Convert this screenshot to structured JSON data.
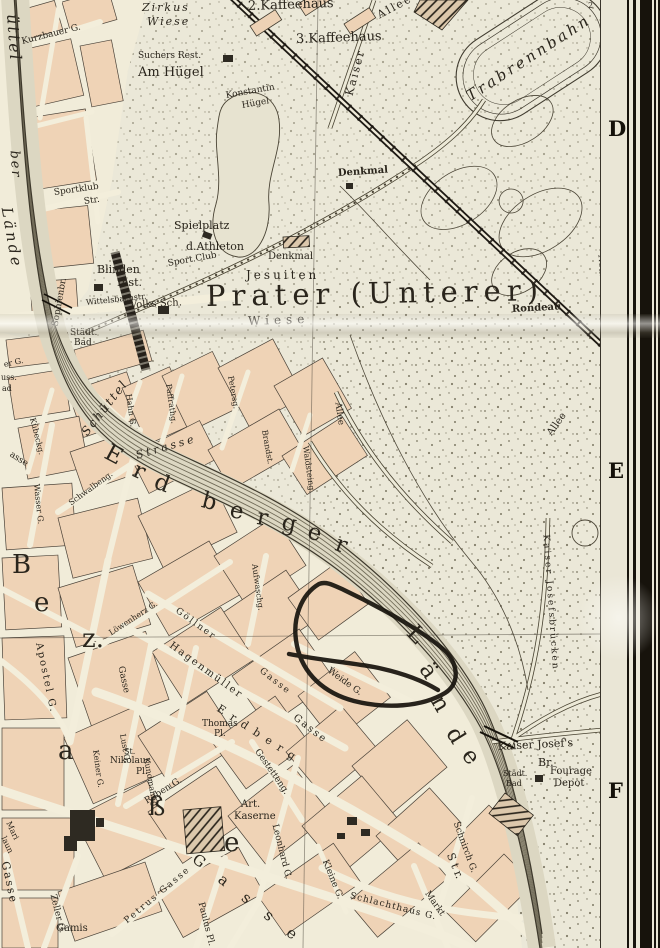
{
  "map": {
    "region_title": "Prater (Unterer)",
    "colors": {
      "paper": "#ebe8d8",
      "city_block": "#efd3b6",
      "street": "#f3eedb",
      "print_ink": "#2a251c",
      "water_hatch": "#57513e",
      "handwritten_annotation": "#17130d",
      "margin_paper": "#eae6d6",
      "frame_bar": "#17130c"
    },
    "annotation_ink": {
      "description": "hand-drawn black ink loop around blocks near Weide G.",
      "color": "#17130d"
    },
    "margin": {
      "letters": [
        {
          "t": "D",
          "y": 116
        },
        {
          "t": "E",
          "y": 458
        },
        {
          "t": "F",
          "y": 778
        }
      ]
    },
    "labels": [
      {
        "t": "Zirkus",
        "x": 142,
        "y": 2,
        "r": 0,
        "s": 11,
        "c": "pli sp2"
      },
      {
        "t": "Wiese",
        "x": 147,
        "y": 16,
        "r": 0,
        "s": 11,
        "c": "pli sp2"
      },
      {
        "t": "2.Kaffeehaus",
        "x": 248,
        "y": 0,
        "r": -2,
        "s": 13,
        "c": "pl"
      },
      {
        "t": "3.Kaffeehaus",
        "x": 296,
        "y": 33,
        "r": -2,
        "s": 13,
        "c": "pl"
      },
      {
        "t": "Suchers Rest.",
        "x": 138,
        "y": 52,
        "r": 0,
        "s": 9,
        "c": "pl"
      },
      {
        "t": "Am Hügel",
        "x": 138,
        "y": 66,
        "r": 0,
        "s": 13,
        "c": "pl"
      },
      {
        "t": "Konstantin",
        "x": 226,
        "y": 92,
        "r": -10,
        "s": 9,
        "c": "pl"
      },
      {
        "t": "Hügel",
        "x": 242,
        "y": 102,
        "r": -10,
        "s": 9,
        "c": "pl"
      },
      {
        "t": "Kaiser",
        "x": 349,
        "y": 90,
        "r": -75,
        "s": 11,
        "c": "pl sp2"
      },
      {
        "t": "Allee",
        "x": 378,
        "y": 10,
        "r": -28,
        "s": 11,
        "c": "pl sp2"
      },
      {
        "t": "Trabrennbahn",
        "x": 468,
        "y": 90,
        "r": -33,
        "s": 15,
        "c": "pli sp3"
      },
      {
        "t": "Kurzbauer G.",
        "x": 22,
        "y": 38,
        "r": -14,
        "s": 9,
        "c": "st"
      },
      {
        "t": "Sportklub",
        "x": 54,
        "y": 189,
        "r": -8,
        "s": 9,
        "c": "st"
      },
      {
        "t": "Str.",
        "x": 84,
        "y": 198,
        "r": -8,
        "s": 9,
        "c": "st"
      },
      {
        "t": "Denkmal",
        "x": 338,
        "y": 169,
        "r": -4,
        "s": 10,
        "c": "plb"
      },
      {
        "t": "Spielplatz",
        "x": 174,
        "y": 220,
        "r": 0,
        "s": 11,
        "c": "pl"
      },
      {
        "t": "d.Athleton",
        "x": 186,
        "y": 241,
        "r": 0,
        "s": 11,
        "c": "pl"
      },
      {
        "t": "Sport.Club",
        "x": 168,
        "y": 260,
        "r": -10,
        "s": 9,
        "c": "st"
      },
      {
        "t": "Denkmal",
        "x": 268,
        "y": 252,
        "r": 0,
        "s": 10,
        "c": "pl"
      },
      {
        "t": "Blinden",
        "x": 97,
        "y": 264,
        "r": 0,
        "s": 11,
        "c": "pl"
      },
      {
        "t": "Inst.",
        "x": 117,
        "y": 277,
        "r": 0,
        "s": 11,
        "c": "pl"
      },
      {
        "t": "Volks Sch.",
        "x": 130,
        "y": 301,
        "r": -3,
        "s": 10,
        "c": "pl"
      },
      {
        "t": "Wittelsbachstr.",
        "x": 86,
        "y": 299,
        "r": -6,
        "s": 8,
        "c": "st"
      },
      {
        "t": "Jesuiten",
        "x": 246,
        "y": 269,
        "r": 0,
        "s": 12,
        "c": "pl sp3"
      },
      {
        "t": "Prater (Unterer)",
        "x": 206,
        "y": 282,
        "r": -1,
        "s": 29,
        "c": "big"
      },
      {
        "t": "Wiese",
        "x": 248,
        "y": 315,
        "r": -2,
        "s": 12,
        "c": "pl sp4"
      },
      {
        "t": "Rondeau",
        "x": 512,
        "y": 305,
        "r": -3,
        "s": 10,
        "c": "plb"
      },
      {
        "t": "Städt.",
        "x": 70,
        "y": 329,
        "r": 0,
        "s": 9,
        "c": "st"
      },
      {
        "t": "Bad",
        "x": 74,
        "y": 339,
        "r": 0,
        "s": 9,
        "c": "st"
      },
      {
        "t": "Sophienbr.",
        "x": 56,
        "y": 322,
        "r": -80,
        "s": 9,
        "c": "st"
      },
      {
        "t": "üttel",
        "x": 12,
        "y": 6,
        "r": 86,
        "s": 16,
        "c": "pli sp2"
      },
      {
        "t": "ber",
        "x": 14,
        "y": 144,
        "r": 86,
        "s": 13,
        "c": "pli sp2"
      },
      {
        "t": "Lände",
        "x": 6,
        "y": 200,
        "r": 80,
        "s": 15,
        "c": "pli sp3"
      },
      {
        "t": "Neustädt. Wasser",
        "x": 600,
        "y": 250,
        "r": 86,
        "s": 9,
        "c": "st"
      },
      {
        "t": "2",
        "x": 588,
        "y": 2,
        "r": 0,
        "s": 8,
        "c": "st"
      },
      {
        "t": "Schüttel",
        "x": 84,
        "y": 428,
        "r": -52,
        "s": 12,
        "c": "pli sp2"
      },
      {
        "t": "Strasse",
        "x": 136,
        "y": 450,
        "r": -16,
        "s": 11,
        "c": "pli sp3"
      },
      {
        "t": "E",
        "x": 106,
        "y": 440,
        "r": 28,
        "s": 23,
        "c": "lg"
      },
      {
        "t": "r",
        "x": 134,
        "y": 458,
        "r": 24,
        "s": 23,
        "c": "lg"
      },
      {
        "t": "d",
        "x": 155,
        "y": 470,
        "r": 20,
        "s": 23,
        "c": "lg"
      },
      {
        "t": "b",
        "x": 202,
        "y": 489,
        "r": 14,
        "s": 23,
        "c": "lg"
      },
      {
        "t": "e",
        "x": 230,
        "y": 499,
        "r": 10,
        "s": 23,
        "c": "lg"
      },
      {
        "t": "r",
        "x": 257,
        "y": 506,
        "r": 10,
        "s": 23,
        "c": "lg"
      },
      {
        "t": "g",
        "x": 282,
        "y": 511,
        "r": 12,
        "s": 23,
        "c": "lg"
      },
      {
        "t": "e",
        "x": 308,
        "y": 520,
        "r": 16,
        "s": 23,
        "c": "lg"
      },
      {
        "t": "r",
        "x": 336,
        "y": 532,
        "r": 20,
        "s": 23,
        "c": "lg"
      },
      {
        "t": "L",
        "x": 410,
        "y": 618,
        "r": 46,
        "s": 23,
        "c": "lg"
      },
      {
        "t": "ä",
        "x": 424,
        "y": 654,
        "r": 55,
        "s": 23,
        "c": "lg"
      },
      {
        "t": "n",
        "x": 436,
        "y": 686,
        "r": 60,
        "s": 23,
        "c": "lg"
      },
      {
        "t": "d",
        "x": 451,
        "y": 718,
        "r": 58,
        "s": 23,
        "c": "lg"
      },
      {
        "t": "e",
        "x": 466,
        "y": 740,
        "r": 52,
        "s": 23,
        "c": "lg"
      },
      {
        "t": "Hahn G.",
        "x": 128,
        "y": 390,
        "r": 82,
        "s": 8,
        "c": "st"
      },
      {
        "t": "Paffrathg.",
        "x": 168,
        "y": 380,
        "r": 82,
        "s": 8,
        "c": "st"
      },
      {
        "t": "Petersg.",
        "x": 230,
        "y": 372,
        "r": 80,
        "s": 8,
        "c": "st"
      },
      {
        "t": "Brandst.",
        "x": 264,
        "y": 426,
        "r": 80,
        "s": 8,
        "c": "st"
      },
      {
        "t": "Kübeckg.",
        "x": 32,
        "y": 414,
        "r": 76,
        "s": 8,
        "c": "st"
      },
      {
        "t": "asse",
        "x": 10,
        "y": 450,
        "r": 32,
        "s": 9,
        "c": "st"
      },
      {
        "t": "Wasser G.",
        "x": 36,
        "y": 480,
        "r": 84,
        "s": 8,
        "c": "st"
      },
      {
        "t": "Schwalbeng.",
        "x": 70,
        "y": 500,
        "r": -36,
        "s": 8,
        "c": "st"
      },
      {
        "t": "uss.",
        "x": 1,
        "y": 374,
        "r": 0,
        "s": 8,
        "c": "st"
      },
      {
        "t": "ad",
        "x": 2,
        "y": 385,
        "r": 0,
        "s": 8,
        "c": "st"
      },
      {
        "t": "er G.",
        "x": 4,
        "y": 361,
        "r": -12,
        "s": 8,
        "c": "st"
      },
      {
        "t": "Allee",
        "x": 337,
        "y": 398,
        "r": 82,
        "s": 9,
        "c": "st"
      },
      {
        "t": "Waldsteing.",
        "x": 305,
        "y": 442,
        "r": 82,
        "s": 8,
        "c": "st"
      },
      {
        "t": "Allee",
        "x": 550,
        "y": 430,
        "r": -55,
        "s": 10,
        "c": "pl"
      },
      {
        "t": "Löwenherz G.",
        "x": 110,
        "y": 630,
        "r": -33,
        "s": 8,
        "c": "st"
      },
      {
        "t": "Göllner",
        "x": 176,
        "y": 606,
        "r": 36,
        "s": 9,
        "c": "st sp2"
      },
      {
        "t": "Gasse",
        "x": 260,
        "y": 666,
        "r": 38,
        "s": 9,
        "c": "st sp2"
      },
      {
        "t": "Hagenmüller",
        "x": 170,
        "y": 640,
        "r": 36,
        "s": 10,
        "c": "st sp2"
      },
      {
        "t": "Gasse",
        "x": 294,
        "y": 712,
        "r": 38,
        "s": 10,
        "c": "st sp2"
      },
      {
        "t": "Aufwaschg.",
        "x": 254,
        "y": 560,
        "r": 82,
        "s": 8,
        "c": "st"
      },
      {
        "t": "Weide G.",
        "x": 328,
        "y": 666,
        "r": 36,
        "s": 9,
        "c": "st"
      },
      {
        "t": "Apostel G.",
        "x": 38,
        "y": 638,
        "r": 78,
        "s": 10,
        "c": "st sp2"
      },
      {
        "t": "Gasse",
        "x": 120,
        "y": 662,
        "r": 78,
        "s": 9,
        "c": "st"
      },
      {
        "t": "Thomas",
        "x": 202,
        "y": 720,
        "r": 0,
        "s": 9,
        "c": "pl"
      },
      {
        "t": "Pl.",
        "x": 214,
        "y": 730,
        "r": 0,
        "s": 9,
        "c": "pl"
      },
      {
        "t": "St.",
        "x": 124,
        "y": 748,
        "r": 0,
        "s": 8,
        "c": "pl"
      },
      {
        "t": "Nikolaus",
        "x": 110,
        "y": 757,
        "r": 0,
        "s": 9,
        "c": "pl"
      },
      {
        "t": "Pl.",
        "x": 136,
        "y": 768,
        "r": 0,
        "s": 9,
        "c": "pl"
      },
      {
        "t": "Lust G.",
        "x": 122,
        "y": 730,
        "r": 80,
        "s": 8,
        "c": "st"
      },
      {
        "t": "Kundmanng.",
        "x": 146,
        "y": 754,
        "r": 80,
        "s": 8,
        "c": "st"
      },
      {
        "t": "Raben G.",
        "x": 146,
        "y": 798,
        "r": -32,
        "s": 9,
        "c": "st"
      },
      {
        "t": "Keiner G.",
        "x": 95,
        "y": 746,
        "r": 82,
        "s": 8,
        "c": "st"
      },
      {
        "t": "B",
        "x": 12,
        "y": 552,
        "r": 0,
        "s": 26,
        "c": "lg"
      },
      {
        "t": "e",
        "x": 34,
        "y": 590,
        "r": 0,
        "s": 26,
        "c": "lg"
      },
      {
        "t": "z.",
        "x": 82,
        "y": 626,
        "r": 0,
        "s": 26,
        "c": "lg"
      },
      {
        "t": "a",
        "x": 58,
        "y": 738,
        "r": 0,
        "s": 26,
        "c": "lg"
      },
      {
        "t": "ß",
        "x": 148,
        "y": 794,
        "r": 0,
        "s": 26,
        "c": "lg"
      },
      {
        "t": "e",
        "x": 224,
        "y": 830,
        "r": 0,
        "s": 26,
        "c": "lg"
      },
      {
        "t": "Art.",
        "x": 241,
        "y": 800,
        "r": 0,
        "s": 10,
        "c": "pl"
      },
      {
        "t": "Kaserne",
        "x": 234,
        "y": 812,
        "r": 0,
        "s": 10,
        "c": "pl"
      },
      {
        "t": "Gestetteng.",
        "x": 256,
        "y": 746,
        "r": 55,
        "s": 9,
        "c": "st"
      },
      {
        "t": "E r d b e r g",
        "x": 218,
        "y": 702,
        "r": 33,
        "s": 11,
        "c": "st sp2"
      },
      {
        "t": "S t r.",
        "x": 450,
        "y": 848,
        "r": 68,
        "s": 11,
        "c": "st"
      },
      {
        "t": "Schnirch G.",
        "x": 455,
        "y": 818,
        "r": 70,
        "s": 9,
        "c": "st"
      },
      {
        "t": "Kleine G.",
        "x": 324,
        "y": 856,
        "r": 68,
        "s": 9,
        "c": "st"
      },
      {
        "t": "Schlachthaus G.",
        "x": 350,
        "y": 892,
        "r": 14,
        "s": 9,
        "c": "st sp1"
      },
      {
        "t": "Markt",
        "x": 426,
        "y": 888,
        "r": 55,
        "s": 9,
        "c": "st"
      },
      {
        "t": "Petrus Gasse",
        "x": 126,
        "y": 918,
        "r": -40,
        "s": 9,
        "c": "st sp2"
      },
      {
        "t": "Paulus Pl.",
        "x": 200,
        "y": 898,
        "r": 76,
        "s": 9,
        "c": "st"
      },
      {
        "t": "Leonhard G.",
        "x": 274,
        "y": 820,
        "r": 76,
        "s": 9,
        "c": "st"
      },
      {
        "t": "G a s s e",
        "x": 194,
        "y": 850,
        "r": 38,
        "s": 15,
        "c": "lg2"
      },
      {
        "t": "Zeller G.",
        "x": 52,
        "y": 890,
        "r": 76,
        "s": 9,
        "c": "st"
      },
      {
        "t": "Gamis",
        "x": 56,
        "y": 924,
        "r": 0,
        "s": 10,
        "c": "pl"
      },
      {
        "t": "Mari",
        "x": 8,
        "y": 818,
        "r": 65,
        "s": 8,
        "c": "st"
      },
      {
        "t": "laun",
        "x": 3,
        "y": 833,
        "r": 65,
        "s": 8,
        "c": "st"
      },
      {
        "t": "Gasse",
        "x": 5,
        "y": 856,
        "r": 78,
        "s": 11,
        "c": "st sp2"
      },
      {
        "t": "Kaiser Josef's",
        "x": 498,
        "y": 741,
        "r": -3,
        "s": 11,
        "c": "pl"
      },
      {
        "t": "Br.",
        "x": 538,
        "y": 757,
        "r": 0,
        "s": 11,
        "c": "pl"
      },
      {
        "t": "Fourage",
        "x": 550,
        "y": 767,
        "r": 0,
        "s": 10,
        "c": "pl"
      },
      {
        "t": "Depot",
        "x": 554,
        "y": 779,
        "r": 0,
        "s": 10,
        "c": "pl"
      },
      {
        "t": "Städt.",
        "x": 503,
        "y": 770,
        "r": 0,
        "s": 8,
        "c": "st"
      },
      {
        "t": "Bad",
        "x": 506,
        "y": 780,
        "r": 0,
        "s": 8,
        "c": "st"
      },
      {
        "t": "Kaiser Josefsbrücken",
        "x": 545,
        "y": 530,
        "r": 86,
        "s": 9,
        "c": "st sp2"
      }
    ]
  }
}
